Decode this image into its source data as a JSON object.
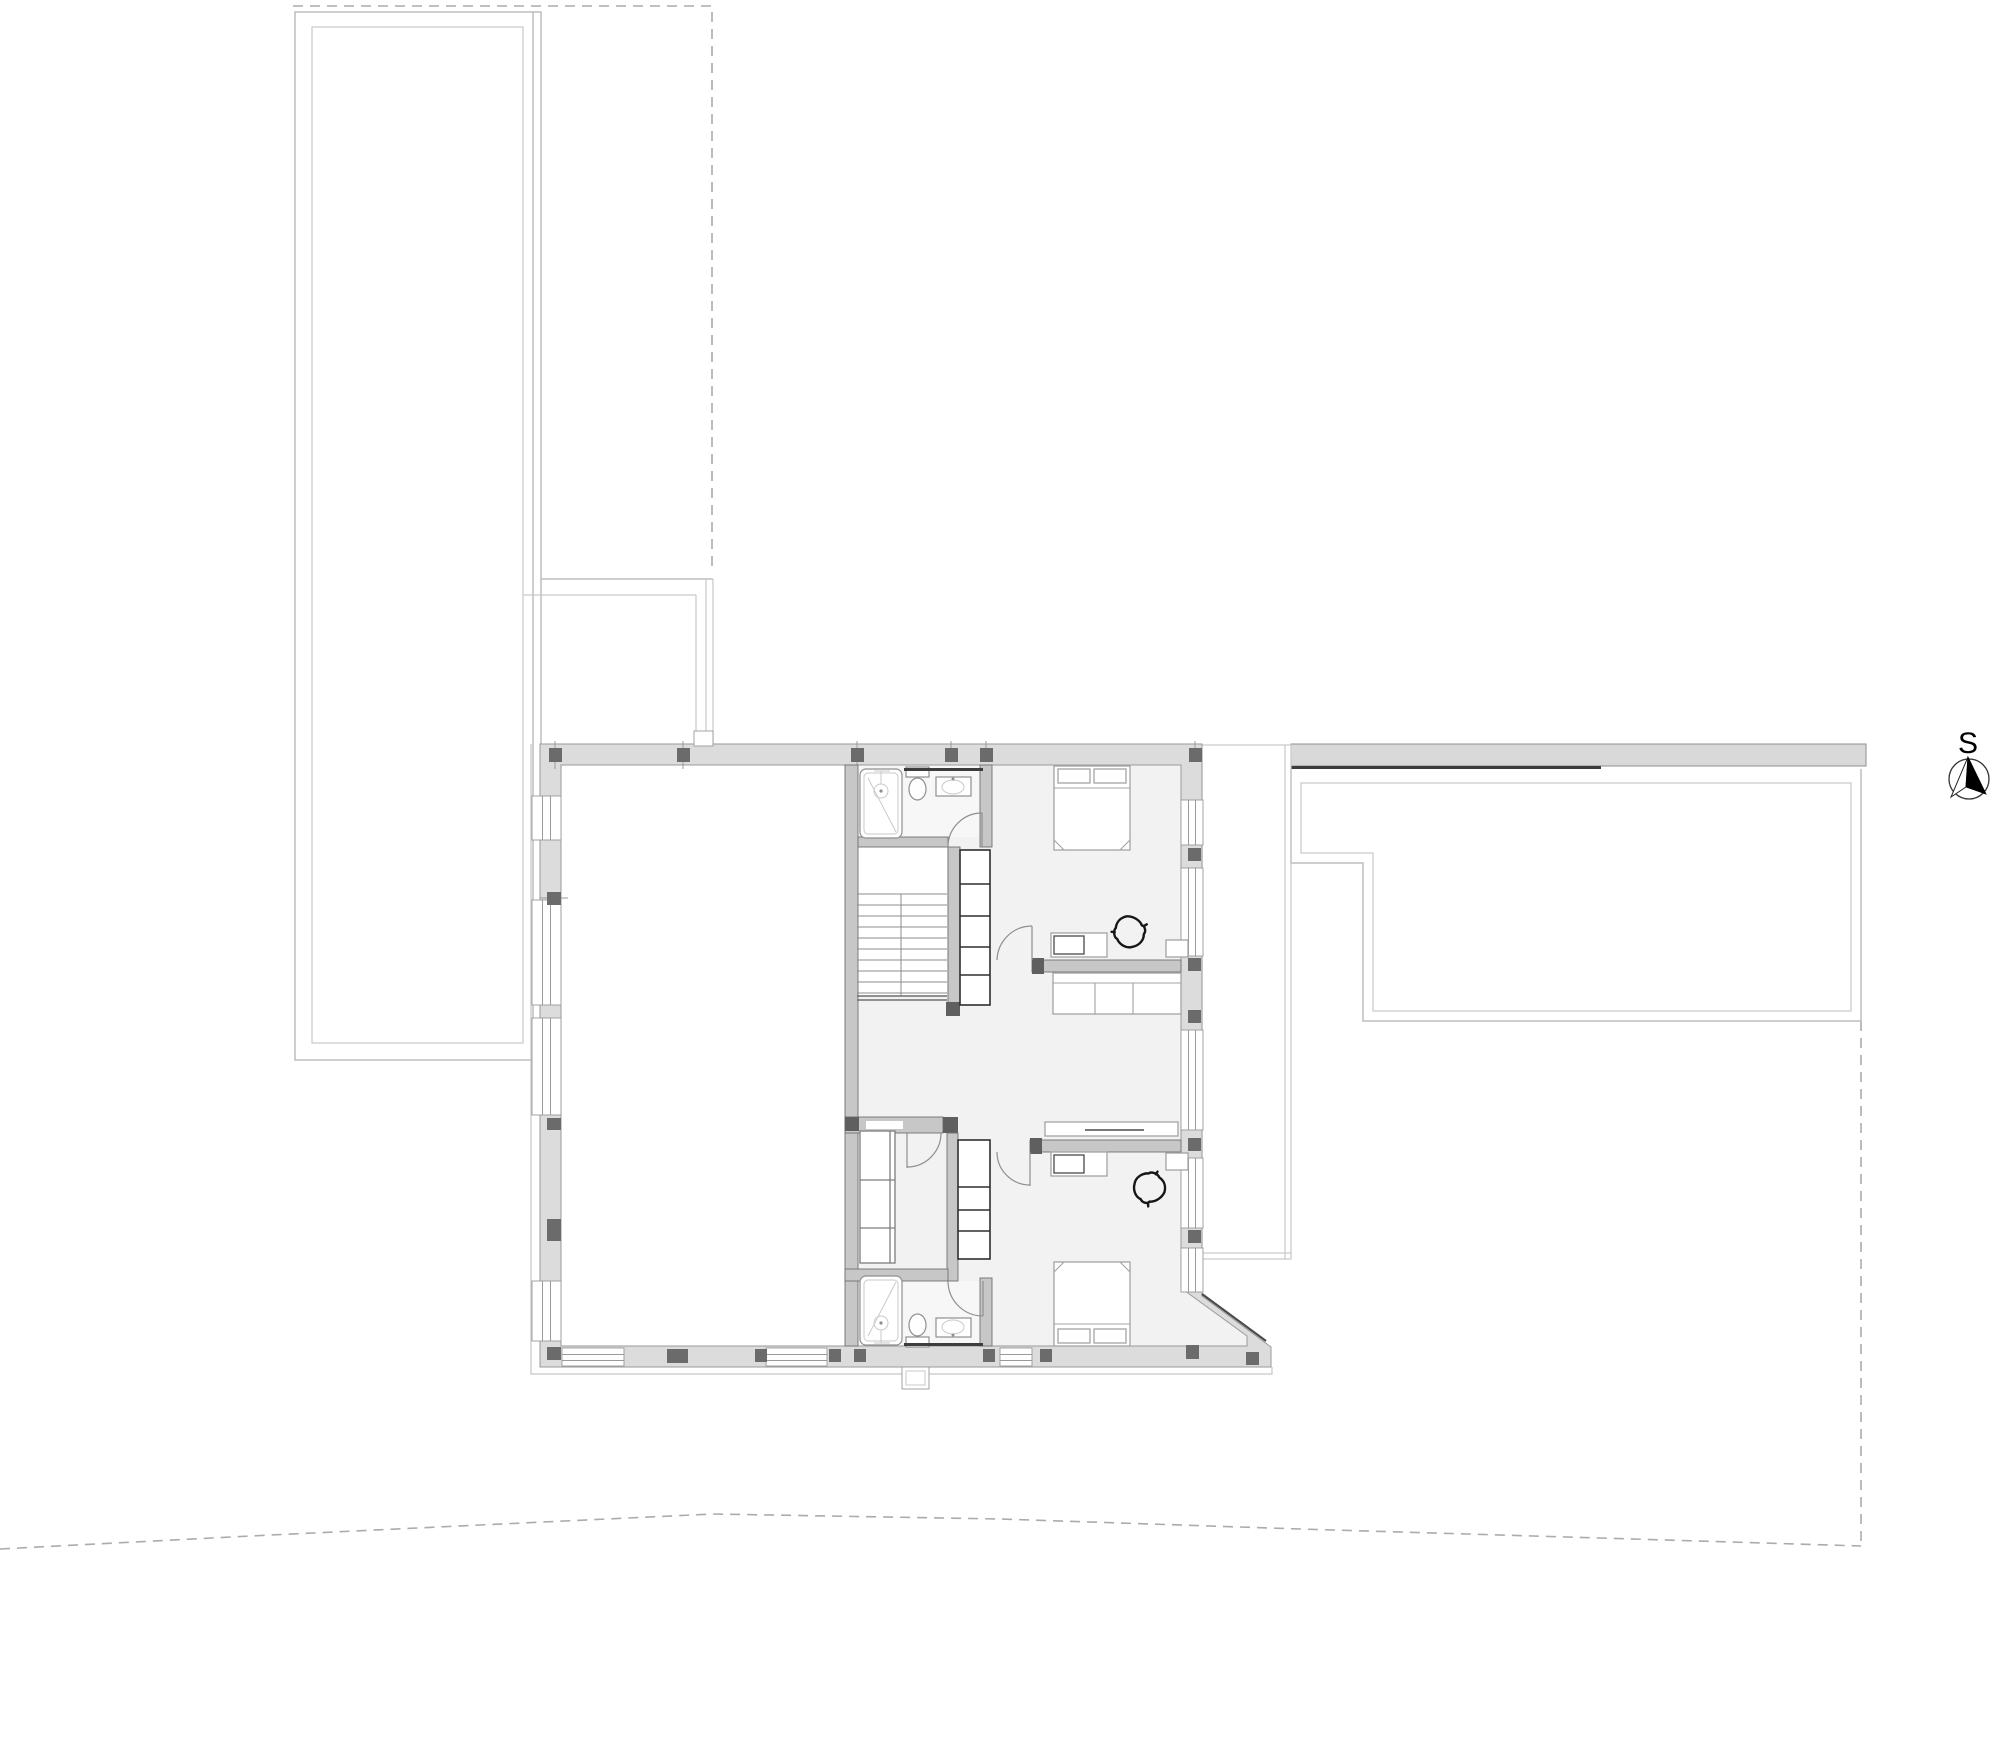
{
  "document": {
    "title": "Upper floor architectural plan",
    "background": "#ffffff"
  },
  "compass": {
    "label": "S",
    "style": "circle-with-split-needle"
  },
  "colors": {
    "exterior_wall_fill": "#dcdcdc",
    "exterior_wall_stroke": "#9a9a9a",
    "column_fill": "#6b6b6b",
    "interior_wall_fill": "#c7c7c7",
    "interior_wall_stroke": "#707070",
    "floor_fill": "#f2f2f2",
    "bath_floor_fill": "#f7f7f7",
    "roof_outline": "#bdbdbd",
    "roof_band_fill": "#d9d9d9",
    "dark_accent": "#3d3d3d",
    "property_line": "#ababab",
    "fixture_stroke": "#8f8f8f",
    "furniture_stroke": "#a3a3a3",
    "closet_stroke": "#2f2f2f",
    "chair_stroke": "#161616"
  },
  "plan": {
    "rooms": [
      "void-over-lower-level",
      "stair-hall",
      "bedroom-north",
      "bedroom-south",
      "bathroom-north",
      "bathroom-south",
      "walk-in-closet",
      "terrace-east"
    ],
    "fixtures": [
      "shower",
      "toilet",
      "washbasin",
      "shower",
      "toilet",
      "washbasin"
    ],
    "furniture": [
      "double-bed-north",
      "double-bed-south",
      "sofa",
      "desk-north",
      "swivel-chair-north",
      "desk-south",
      "swivel-chair-south",
      "wardrobe",
      "shelf-unit-north",
      "shelf-unit-south",
      "console"
    ],
    "stairs": {
      "treads": 10,
      "runs": 2
    },
    "site": [
      "property-line-northwest",
      "property-line-east",
      "terrain-line-south",
      "flat-roof-west",
      "flat-roof-east"
    ]
  }
}
